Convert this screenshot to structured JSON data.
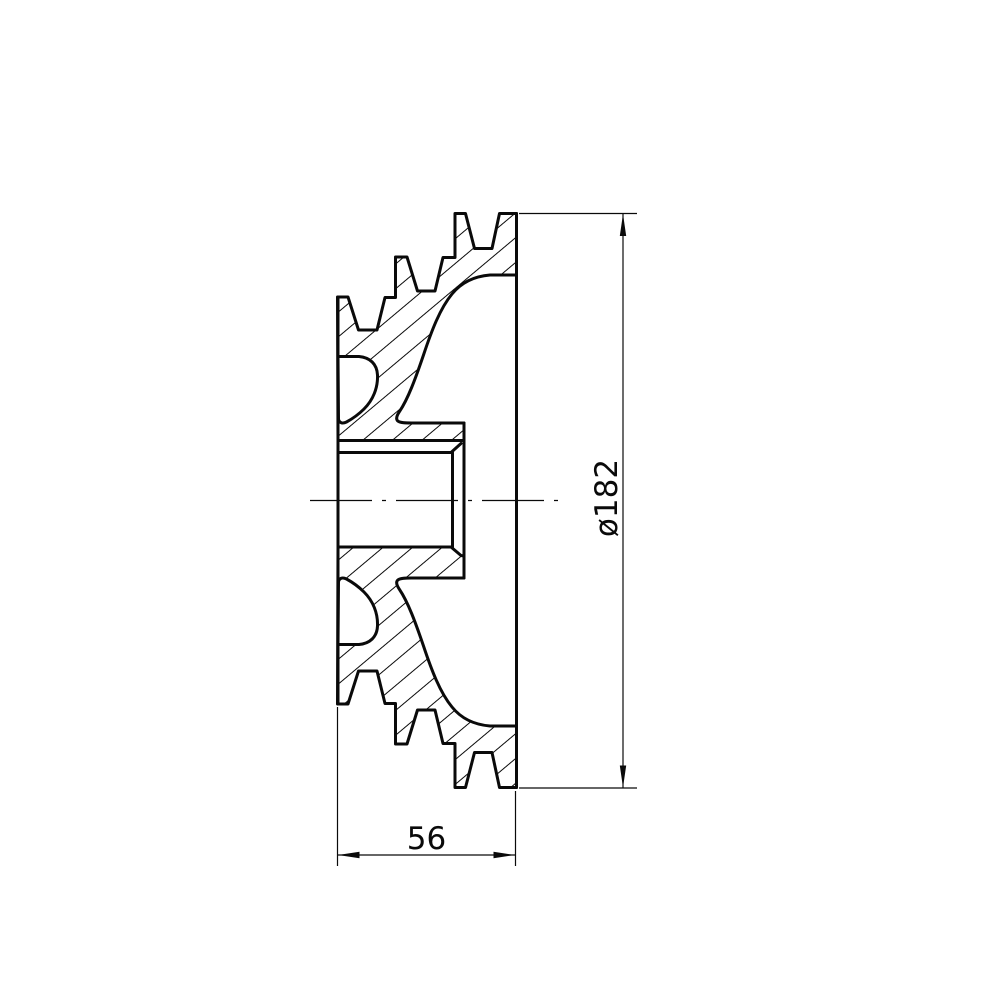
{
  "drawing": {
    "description": "V-belt pulley cross-section, side view",
    "colors": {
      "background": "#ffffff",
      "line": "#0a0a0a"
    },
    "dimensions": {
      "diameter": {
        "label": "ø182",
        "value": 182,
        "orientation": "vertical"
      },
      "width": {
        "label": "56",
        "value": 56,
        "orientation": "horizontal"
      }
    }
  }
}
